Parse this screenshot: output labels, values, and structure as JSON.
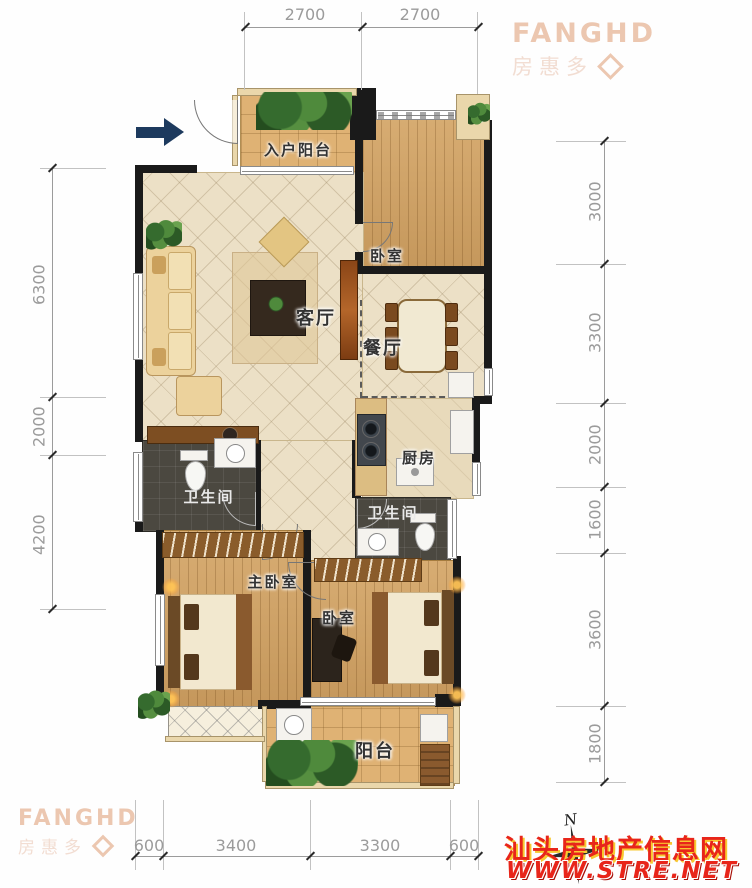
{
  "logo": {
    "name": "FANGHD",
    "cn": "房惠多"
  },
  "rooms": {
    "entry_balcony": "入户阳台",
    "bedroom_top": "卧室",
    "living": "客厅",
    "dining": "餐厅",
    "kitchen": "厨房",
    "bath1": "卫生间",
    "bath2": "卫生间",
    "master": "主卧室",
    "bedroom2": "卧室",
    "balcony": "阳台"
  },
  "dims": {
    "top": [
      "2700",
      "2700"
    ],
    "left": [
      "6300",
      "2000",
      "4200"
    ],
    "right": [
      "3000",
      "3300",
      "2000",
      "1600",
      "3600",
      "1800"
    ],
    "bottom": [
      "600",
      "3400",
      "3300",
      "600"
    ]
  },
  "watermark": {
    "site": "汕头房地产信息网",
    "url": "WWW.STRE.NET"
  },
  "compass": {
    "north": "N"
  },
  "colors": {
    "wall": "#1a1a1a",
    "wood": "#cf9f60",
    "tile": "#ece0c6",
    "dark_tile": "#4b4840",
    "dimension_gray": "#9b9b9b",
    "logo_peach": "#ecc7b0",
    "watermark_red": "#e8251a",
    "entry_arrow_navy": "#1d3a5e"
  }
}
